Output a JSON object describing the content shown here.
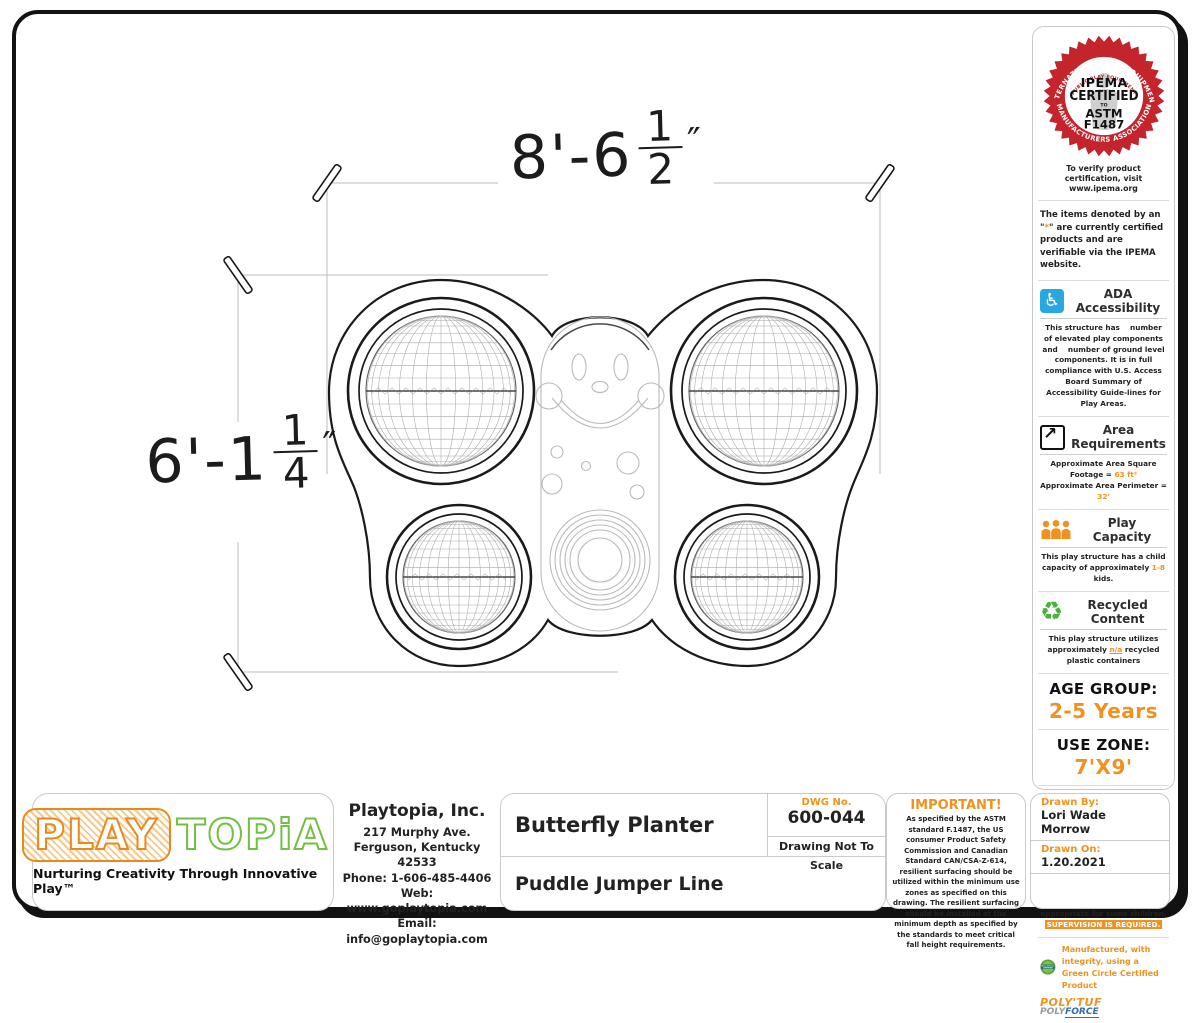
{
  "colors": {
    "accent_orange": "#F0921E",
    "logo_green": "#71BF44",
    "seal_red": "#C4242B",
    "ada_blue": "#29A8E0",
    "polyforce_blue": "#2E6DB4"
  },
  "drawing": {
    "dim_width": {
      "label": "8'-6 1/2\"",
      "main": "8'-6",
      "frac_num": "1",
      "frac_den": "2",
      "unit": "″"
    },
    "dim_height": {
      "label": "6'-1 1/4\"",
      "main": "6'-1",
      "frac_num": "1",
      "frac_den": "4",
      "unit": "″"
    }
  },
  "sidebar": {
    "ipema": {
      "arc_top": "INTERNATIONAL PLAY EQUIPMENT",
      "arc_bottom": "MANUFACTURERS ASSOCIATION",
      "arc_inner": "PUBLIC PLAY EQUIPMENT",
      "brand": "IPEMA",
      "certified": "CERTIFIED",
      "to": "TO",
      "astm": "ASTM",
      "f": "F1487",
      "verify": "To verify product certification, visit www.ipema.org"
    },
    "note_pre": "The items denoted by an \"",
    "note_star": "*",
    "note_post": "\" are currently certified products and are verifiable via the IPEMA website.",
    "ada": {
      "title": "ADA Accessibility",
      "text": "This structure has    number of elevated play components and    number of ground level components. It is in full compliance with U.S. Access Board Summary of Accessibility Guide-lines for Play Areas."
    },
    "area": {
      "title": "Area Requirements",
      "line1_label": "Approximate Area Square Footage = ",
      "line1_value": "63 ft²",
      "line2_label": "Approximate Area Perimeter = ",
      "line2_value": "32'"
    },
    "capacity": {
      "title": "Play Capacity",
      "text_pre": "This play structure has a child capacity of approximately ",
      "value": "1-8",
      "text_post": " kids."
    },
    "recycled": {
      "title": "Recycled Content",
      "text_pre": "This play structure utilizes approximately ",
      "value": "n/a",
      "text_post": " recycled plastic containers"
    },
    "age_group": {
      "label": "AGE GROUP:",
      "value": "2-5 Years"
    },
    "use_zone": {
      "label": "USE ZONE:",
      "value": "7'X9'"
    },
    "playmax": {
      "brand_play": "PLAY",
      "brand_max": "MAX",
      "dot": "·",
      "tagline": "for Structural PIP Pads",
      "text_pre": "This play equipment complies with the safety performance requirements of the age group that is specified in this drawing. Some play equipment may not be appropriate for some children. ",
      "highlight": "SUPERVISION IS REQUIRED."
    },
    "greencircle": {
      "badge_line1": "GreenCircle",
      "badge_line2": "CERTIFIED",
      "text": "Manufactured, with integrity, using a Green Circle Certified Product",
      "brand1": "POLY'TUF",
      "brand2_gray": "POLY",
      "brand2_blue": "FORCE"
    }
  },
  "titleblock": {
    "logo": {
      "play": "PLAY",
      "topia": "TOPiA",
      "tm": "™",
      "tagline": "Nurturing Creativity Through Innovative Play™"
    },
    "company": {
      "name": "Playtopia, Inc.",
      "addr1": "217 Murphy Ave.",
      "addr2": "Ferguson, Kentucky 42533",
      "phone": "Phone: 1-606-485-4406",
      "web": "Web: www.goplaytopia.com",
      "email": "Email: info@goplaytopia.com"
    },
    "product_title": "Butterfly Planter",
    "dwg_label": "DWG No.",
    "dwg_value": "600-044",
    "scale_note": "Drawing Not To Scale",
    "line_title": "Puddle Jumper Line",
    "important": {
      "title": "IMPORTANT!",
      "text": "As specified by the ASTM standard F.1487, the US consumer Product Safety Commission and Canadian Standard CAN/CSA-Z-614, resilient surfacing should be utilized within the minimum use zones as specified on this drawing. The resilient surfacing should be installed at the minimum depth as specified by the standards to meet critical fall height requirements."
    },
    "drawn_by_label": "Drawn By:",
    "drawn_by": "Lori Wade Morrow",
    "drawn_on_label": "Drawn On:",
    "drawn_on": "1.20.2021"
  }
}
